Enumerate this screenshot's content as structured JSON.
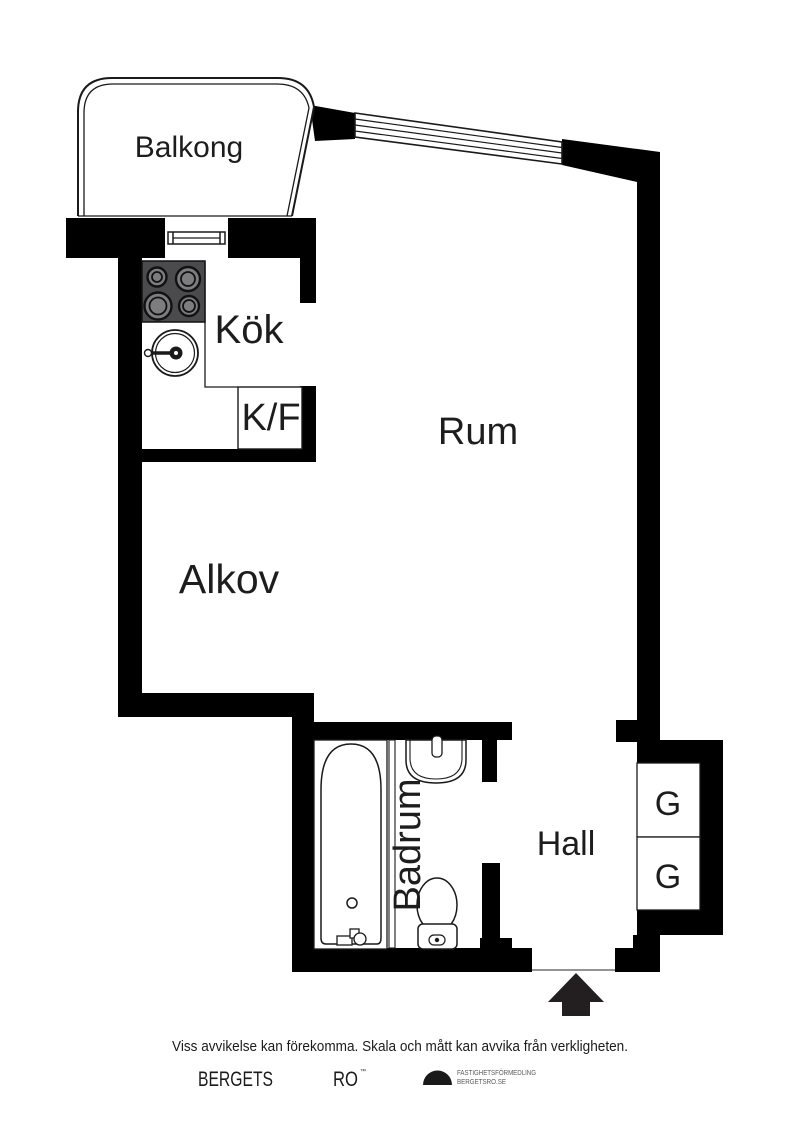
{
  "floorplan": {
    "rooms": {
      "balcony": "Balkong",
      "kitchen": "Kök",
      "fridge_freezer": "K/F",
      "room": "Rum",
      "alcove": "Alkov",
      "bathroom": "Badrum",
      "hall": "Hall",
      "closet_top": "G",
      "closet_bottom": "G"
    },
    "icons": {
      "entrance_arrow": "up-arrow-entrance-marker",
      "logo_mark": "black-half-circle"
    },
    "colors": {
      "wall": "#000000",
      "stove_body": "#4b4b4d",
      "burner": "#7d7d7f",
      "floor": "#ffffff",
      "arrow": "#231f20",
      "logo_text": "#58595b"
    }
  },
  "footer": {
    "disclaimer": "Viss avvikelse kan förekomma. Skala och mått kan avvika från verkligheten.",
    "brand_word1": "BERGETS",
    "brand_word2": "RO",
    "brand_trademark": "™",
    "company_line1": "FASTIGHETSFÖRMEDLING",
    "company_line2": "BERGETSRO.SE"
  }
}
